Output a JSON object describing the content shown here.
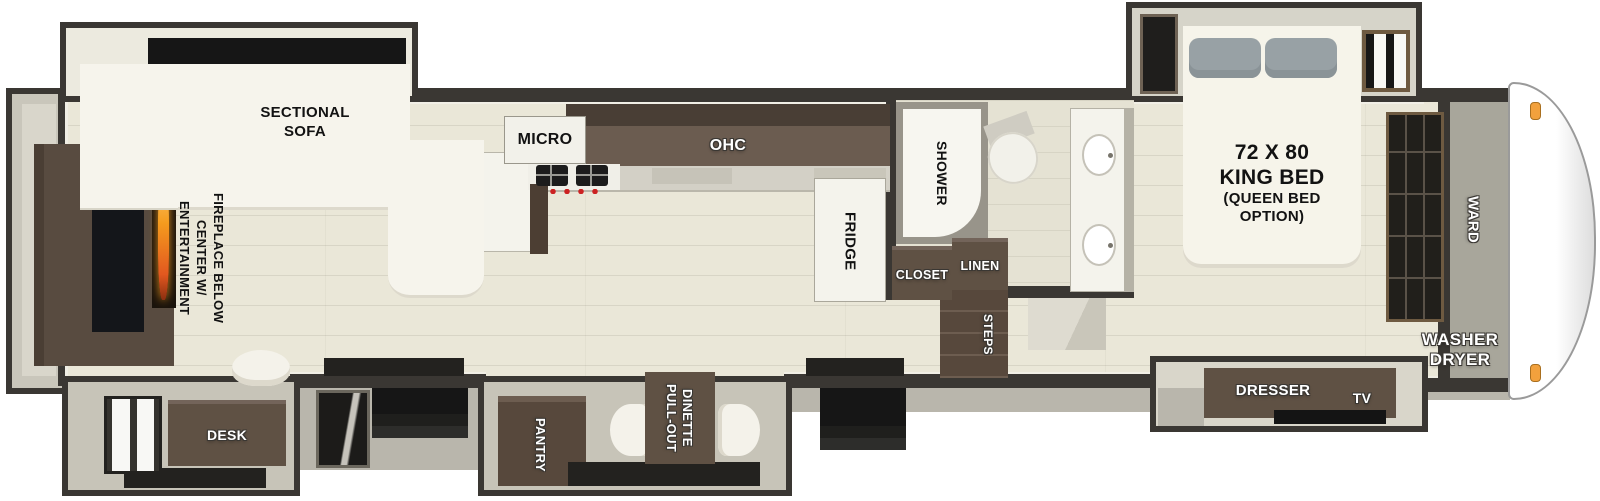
{
  "floorplan": {
    "living": {
      "sectional_sofa": [
        "SECTIONAL",
        "SOFA"
      ],
      "entertainment_center": [
        "ENTERTAINMENT",
        "CENTER W/",
        "FIREPLACE BELOW"
      ],
      "desk": "DESK"
    },
    "kitchen": {
      "micro": "MICRO",
      "ohc": "OHC",
      "fridge": "FRIDGE",
      "pantry": "PANTRY",
      "pull_out_dinette": [
        "PULL-OUT",
        "DINETTE"
      ]
    },
    "bathroom": {
      "shower": "SHOWER",
      "closet": "CLOSET",
      "linen": "LINEN",
      "steps": "STEPS"
    },
    "bedroom": {
      "bed_size": "72 X 80",
      "bed_name": "KING BED",
      "bed_option": [
        "(QUEEN BED",
        "OPTION)"
      ],
      "dresser": "DRESSER",
      "tv": "TV",
      "ward": "WARD",
      "washer_dryer": [
        "WASHER",
        "DRYER"
      ]
    },
    "colors": {
      "wall": "#3a3733",
      "floor": "#eae7d8",
      "cabinet_brown": "#5f5144",
      "ohc_brown": "#6b5c50",
      "white_furniture": "#f6f4ec",
      "pillow_gray": "#98a1a5",
      "flame_orange": "#f59b1e",
      "clearance_light_orange": "#f2a13d",
      "exterior_gray": "#b9b6ac"
    }
  }
}
